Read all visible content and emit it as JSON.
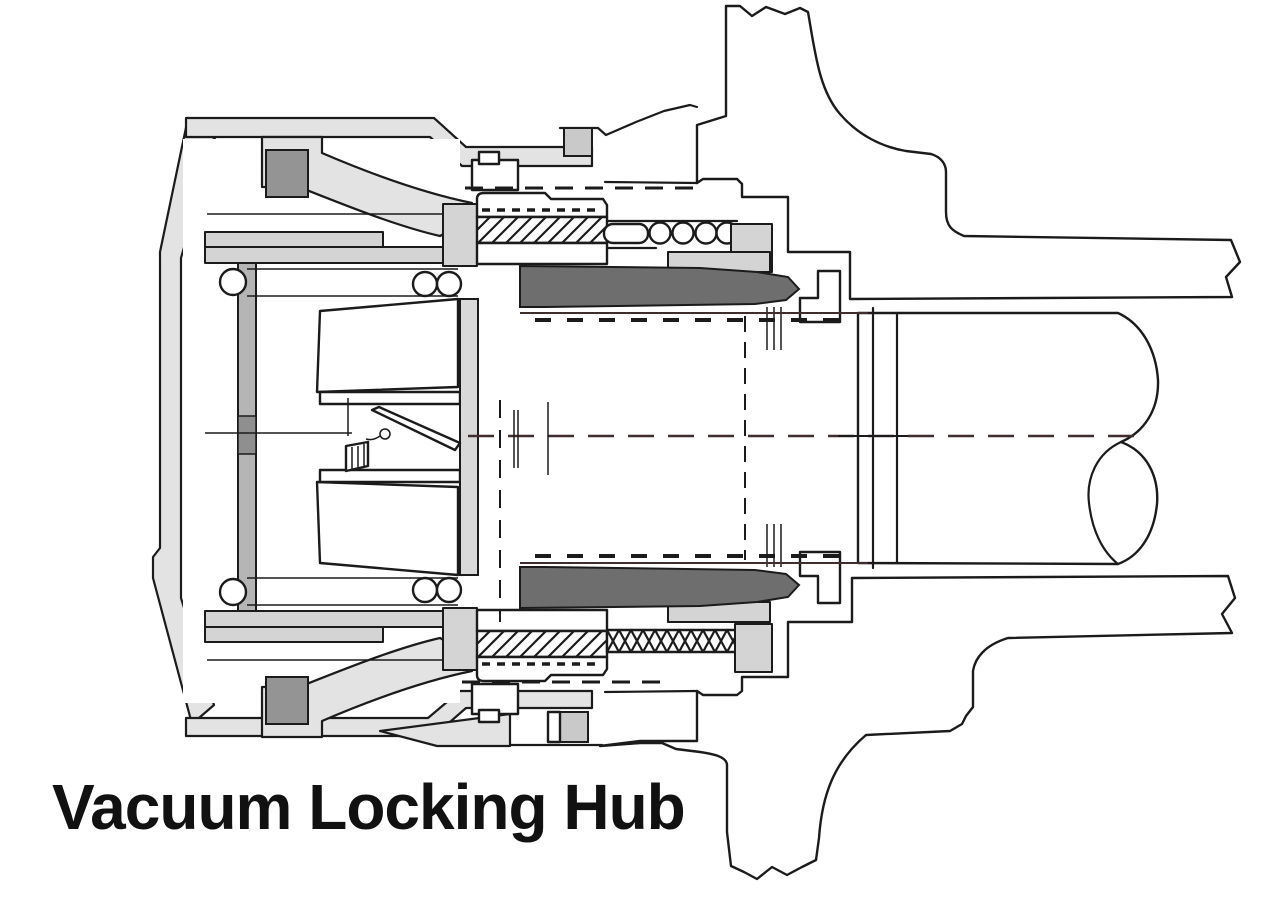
{
  "title": "Vacuum Locking Hub",
  "diagram": {
    "type": "technical-cross-section",
    "subject": "Vacuum locking hub assembly, sectional side view",
    "parts": [
      "hub cap housing",
      "vacuum diaphragm piston",
      "return springs",
      "locking collar",
      "drive spline teeth",
      "coil spring",
      "spindle locknut",
      "wheel bearing bracket",
      "steering knuckle flange",
      "spindle arm",
      "axle shaft",
      "cv joint ball",
      "centerline"
    ]
  },
  "colors": {
    "background": "#ffffff",
    "outline": "#1b1b1b",
    "cap_fill": "#e3e3e3",
    "mid_gray": "#c9c9c9",
    "lining_gray": "#b5b5b5",
    "dark_accent": "#949494",
    "collar_dark": "#6e6e6e",
    "centerline": "#402e2e"
  }
}
